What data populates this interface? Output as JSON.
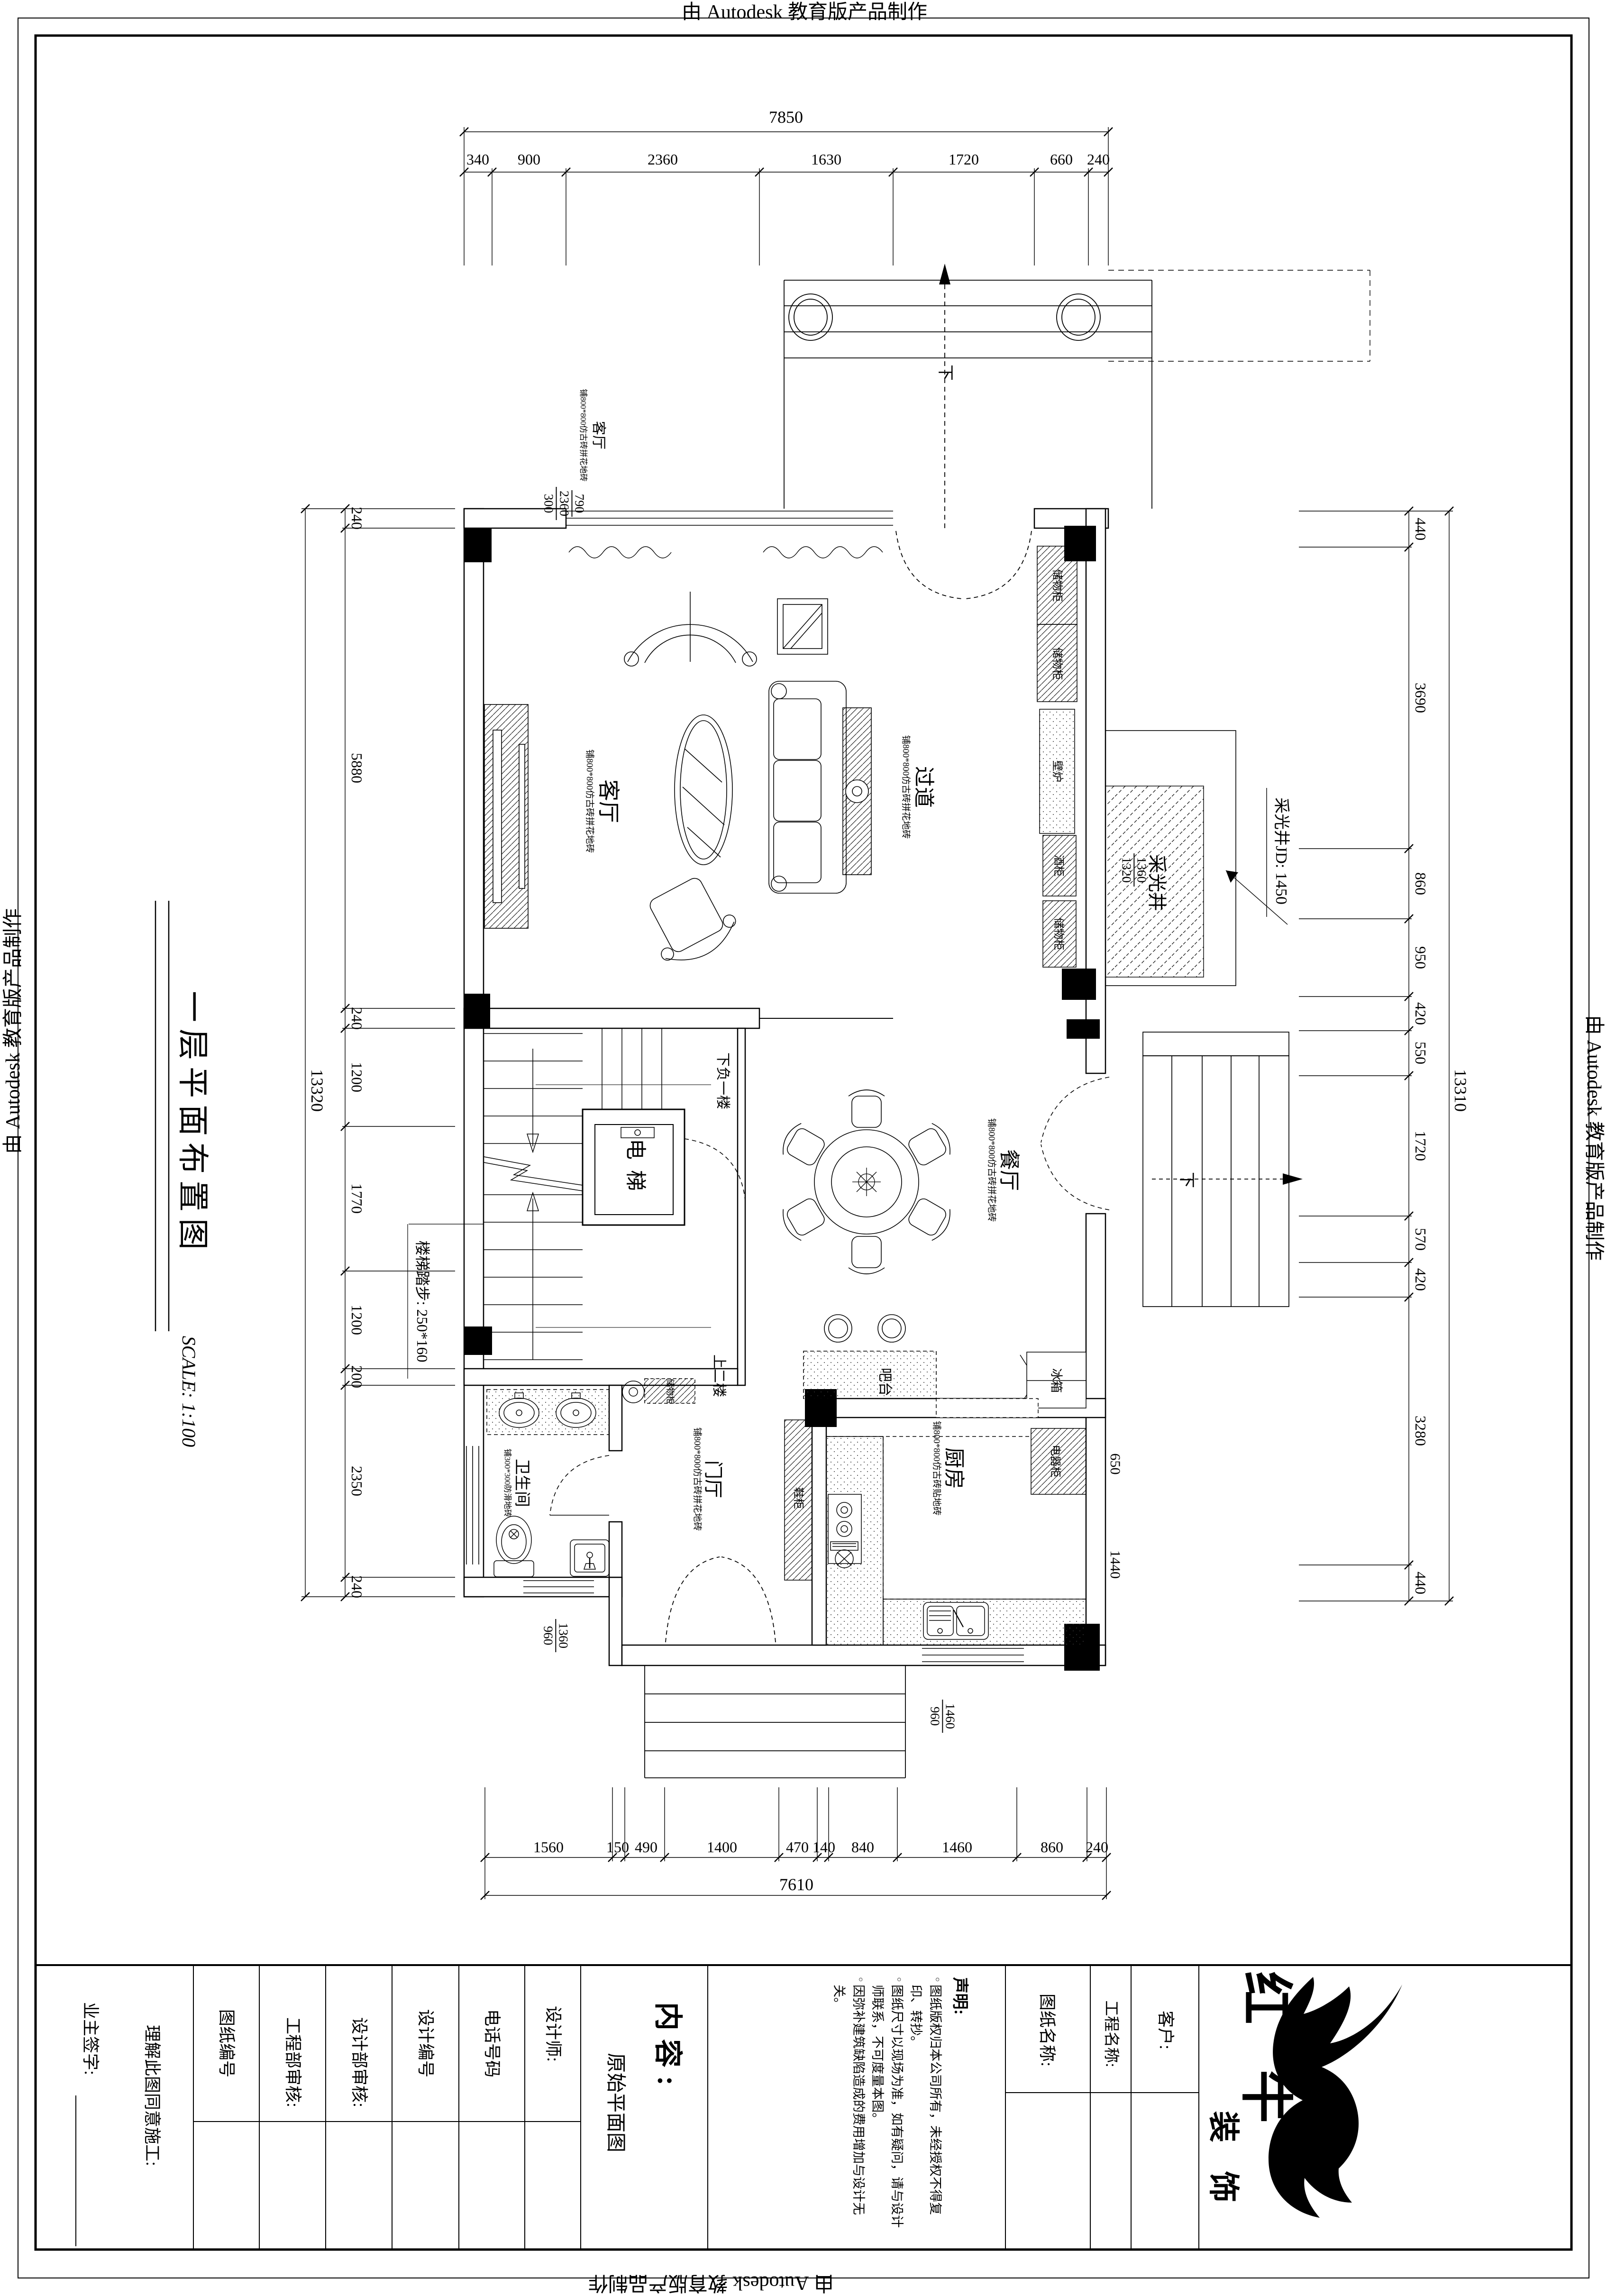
{
  "stamps": {
    "autodesk_top": "由 Autodesk 教育版产品制作",
    "autodesk_bottom": "由 Autodesk 教育版产品制作",
    "autodesk_left": "由 Autodesk 教育版产品制作",
    "autodesk_right": "由 Autodesk 教育版产品制作"
  },
  "sheet": {
    "title": "一层平面布置图",
    "scale": "SCALE: 1:100"
  },
  "dims": {
    "top": {
      "overall": "7850",
      "segments": [
        "340",
        "900",
        "2360",
        "1630",
        "1720",
        "660",
        "240"
      ]
    },
    "bottom": {
      "overall": "7610",
      "segments": [
        "1560",
        "150",
        "490",
        "1400",
        "470",
        "140",
        "840",
        "1460",
        "860",
        "240"
      ]
    },
    "left": {
      "overall": "13320",
      "segments": [
        "240",
        "5880",
        "240",
        "1200",
        "1770",
        "1200",
        "200",
        "2350",
        "240"
      ]
    },
    "right": {
      "overall": "13310",
      "segments": [
        "440",
        "3690",
        "860",
        "950",
        "420",
        "550",
        "1720",
        "570",
        "420",
        "3280",
        "440"
      ]
    },
    "window_stack": [
      "790",
      "2360",
      "300"
    ],
    "lightwell_stack": [
      "1360",
      "1320"
    ],
    "kitchen_650": "650",
    "kitchen_1440": "1440",
    "kitchen_stack": [
      "1460",
      "960"
    ],
    "bath_stack": [
      "1360",
      "960"
    ]
  },
  "rooms": {
    "living": {
      "name": "客厅",
      "sub": "铺800*800仿古砖拼花地砖"
    },
    "corridor": {
      "name": "过道",
      "sub": "铺800*800仿古砖拼花地砖"
    },
    "dining": {
      "name": "餐厅",
      "sub": "铺800*800仿古砖拼花地砖"
    },
    "kitchen": {
      "name": "厨房",
      "sub": "铺800*800仿古砖贴地砖"
    },
    "foyer": {
      "name": "门厅",
      "sub": "铺800*800仿古砖拼花地砖"
    },
    "bath": {
      "name": "卫生间",
      "sub": "铺300*300防滑地砖"
    },
    "lightwell": "采光井",
    "elevator": "电梯",
    "bar": "吧台"
  },
  "fixtures": {
    "storage": "储物柜",
    "wine": "酒柜",
    "fireplace": "壁炉",
    "shoe": "鞋柜",
    "fridge": "冰箱",
    "appliance": "电器柜"
  },
  "annotations": {
    "stair_tread": "楼梯踏步: 250*160",
    "lightwell_jd": "采光井JD: 1450",
    "down_b1": "下负一楼",
    "up_2": "上二楼",
    "down": "下"
  },
  "titleblock": {
    "owner_sign": "业主签字:",
    "agree": "理解此图同意施工:",
    "drawing_no": "图纸编号",
    "eng_audit": "工程部审核:",
    "design_audit": "设计部审核:",
    "design_no": "设计编号",
    "phone": "电话号码",
    "designer": "设计师:",
    "content_label": "内容:",
    "content_value": "原始平面图",
    "statement_title": "声明:",
    "statements": [
      "图纸版权归本公司所有，未经授权不得复印、转抄。",
      "图纸尺寸以现场为准，如有疑问，请与设计师联系，不可度量本图。",
      "因弥补建筑缺陷造成的费用增加与设计无关。"
    ],
    "drawing_name": "图纸名称:",
    "project_name": "工程名称:",
    "client": "客户:",
    "logo_name": "红 牛",
    "logo_suffix": "装 饰"
  }
}
